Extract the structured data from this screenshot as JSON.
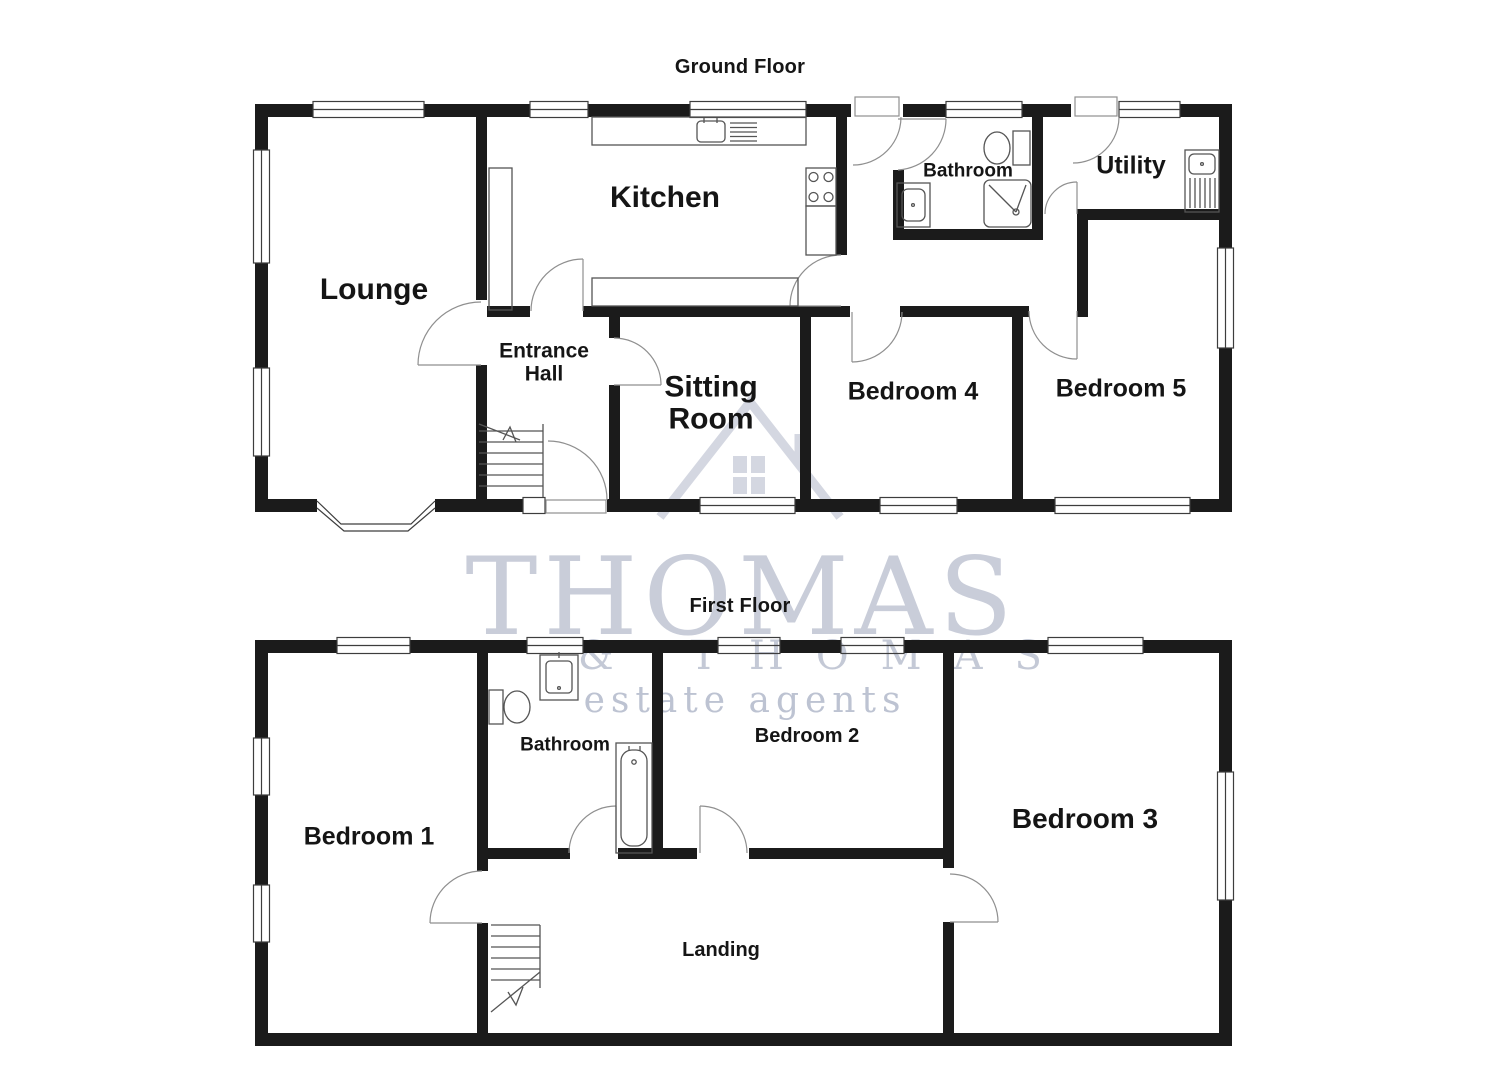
{
  "ground_floor": {
    "title": "Ground Floor",
    "rooms": {
      "lounge": "Lounge",
      "kitchen": "Kitchen",
      "entrance_hall": "Entrance\nHall",
      "sitting_room": "Sitting\nRoom",
      "bathroom": "Bathroom",
      "utility": "Utility",
      "bedroom4": "Bedroom 4",
      "bedroom5": "Bedroom 5"
    }
  },
  "first_floor": {
    "title": "First Floor",
    "rooms": {
      "bedroom1": "Bedroom 1",
      "bathroom": "Bathroom",
      "bedroom2": "Bedroom 2",
      "bedroom3": "Bedroom 3",
      "landing": "Landing"
    }
  },
  "watermark": {
    "name": "THOMAS",
    "secondary": "& THOMAS",
    "tagline": "estate agents"
  },
  "colors": {
    "wall": "#1b1b1b",
    "fixture": "#555555",
    "door": "#8f8f8f",
    "window_frame": "#3d3d3d",
    "watermark_primary": "#c9cdd9",
    "watermark_secondary": "#c4c9d6",
    "watermark_tagline": "#bdc3d2",
    "label": "#151515"
  }
}
